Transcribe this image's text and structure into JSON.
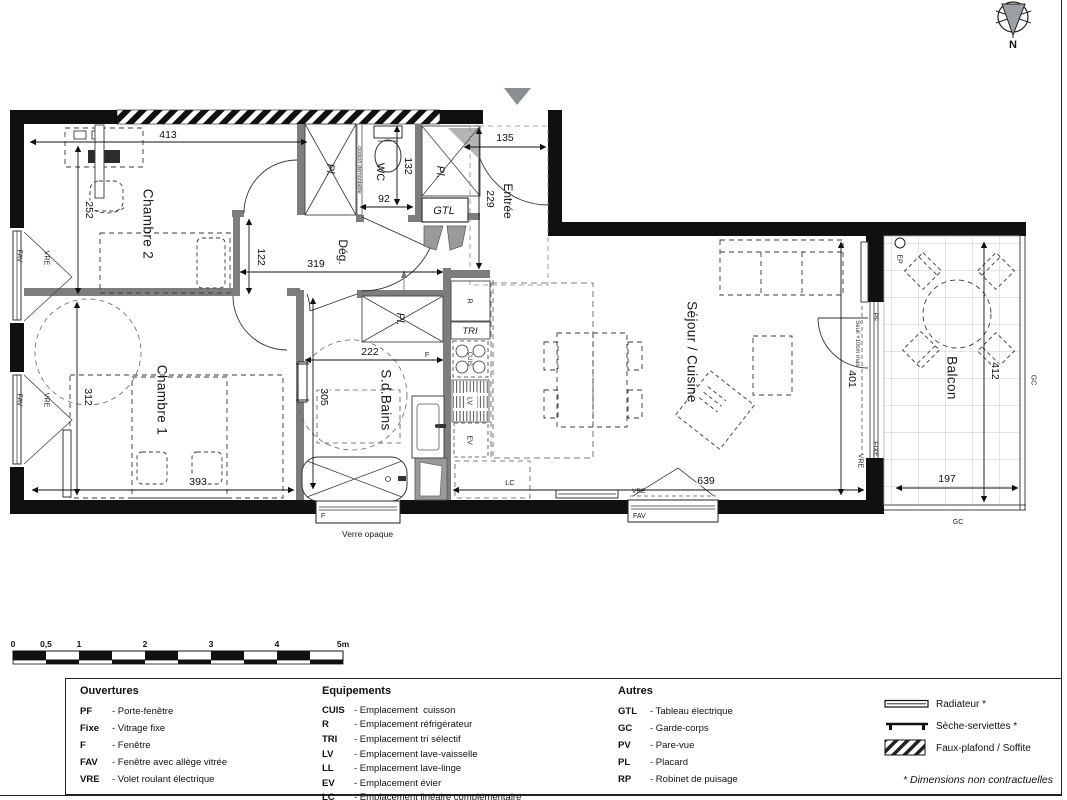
{
  "compass": {
    "north": "N"
  },
  "rooms": {
    "chambre2": "Chambre 2",
    "chambre1": "Chambre 1",
    "sdb": "S.d.Bains",
    "deg": "Dég.",
    "wc": "WC",
    "entree": "Entrée",
    "sejour": "Séjour / Cuisine",
    "balcon": "Balcon",
    "pl": "Pl."
  },
  "small_labels": {
    "gtl": "GTL",
    "tri": "TRI",
    "r": "R",
    "cuis": "CUIS",
    "lv": "LV",
    "ev": "EV",
    "lc": "LC",
    "ep": "EP",
    "pf": "PF",
    "fixe": "FIXE",
    "vre": "VRE",
    "fav": "FAV",
    "f": "F",
    "gc": "GC",
    "seuil": "Seuil +10cm maxi",
    "cloison": "cloison démontable",
    "verre_opaque": "Verre opaque"
  },
  "dims": {
    "d413": "413",
    "d252": "252",
    "d122": "122",
    "d319": "319",
    "d135": "135",
    "d229": "229",
    "d132": "132",
    "d92": "92",
    "d222": "222",
    "d305": "305",
    "d312": "312",
    "d393": "393",
    "d401": "401",
    "d639": "639",
    "d412": "412",
    "d197": "197"
  },
  "scalebar": {
    "t0": "0",
    "t05": "0,5",
    "t1": "1",
    "t2": "2",
    "t3": "3",
    "t4": "4",
    "t5": "5m"
  },
  "legend": {
    "ouvertures": {
      "title": "Ouvertures",
      "items": [
        {
          "code": "PF",
          "desc": "- Porte-fenêtre"
        },
        {
          "code": "Fixe",
          "desc": "- Vitrage fixe"
        },
        {
          "code": "F",
          "desc": "- Fenêtre"
        },
        {
          "code": "FAV",
          "desc": "- Fenêtre avec allège vitrée"
        },
        {
          "code": "VRE",
          "desc": "- Volet roulant électrique"
        }
      ]
    },
    "equipements": {
      "title": "Equipements",
      "items": [
        {
          "code": "CUIS",
          "desc": "- Emplacement  cuisson"
        },
        {
          "code": "R",
          "desc": "- Emplacement réfrigérateur"
        },
        {
          "code": "TRI",
          "desc": "- Emplacement tri sélectif"
        },
        {
          "code": "LV",
          "desc": "- Emplacement lave-vaisselle"
        },
        {
          "code": "LL",
          "desc": "- Emplacement lave-linge"
        },
        {
          "code": "EV",
          "desc": "- Emplacement évier"
        },
        {
          "code": "LC",
          "desc": "- Emplacement linéaire complémentaire"
        }
      ]
    },
    "autres": {
      "title": "Autres",
      "items": [
        {
          "code": "GTL",
          "desc": "- Tableau électrique"
        },
        {
          "code": "GC",
          "desc": "- Garde-corps"
        },
        {
          "code": "PV",
          "desc": "- Pare-vue"
        },
        {
          "code": "PL",
          "desc": "- Placard"
        },
        {
          "code": "RP",
          "desc": "- Robinet de puisage"
        }
      ]
    },
    "symbols": [
      {
        "label": "Radiateur *"
      },
      {
        "label": "Sèche-serviettes *"
      },
      {
        "label": "Faux-plafond / Soffite"
      }
    ],
    "footnote": "* Dimensions non contractuelles"
  }
}
